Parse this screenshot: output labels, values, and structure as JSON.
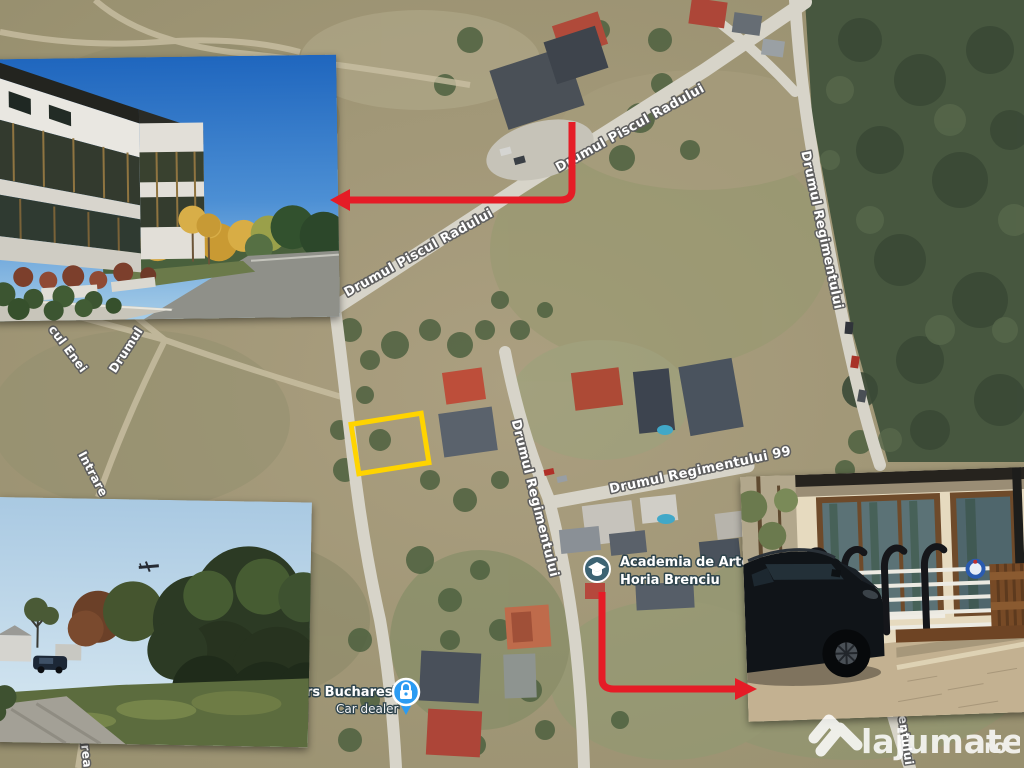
{
  "map": {
    "street_labels": [
      {
        "id": "piscul-radului-lower",
        "text": "Drumul Piscul Radului"
      },
      {
        "id": "piscul-radului-upper",
        "text": "Drumul Piscul Radului"
      },
      {
        "id": "regimentului-right",
        "text": "Drumul Regimentului"
      },
      {
        "id": "regimentului-middle",
        "text": "Drumul Regimentului"
      },
      {
        "id": "regimentului-99",
        "text": "Drumul Regimentului 99"
      },
      {
        "id": "regimentului-bottom-partial",
        "text": "mentului"
      },
      {
        "id": "cul-enei-partial",
        "text": "cul Enei"
      },
      {
        "id": "drumul-partial",
        "text": "Drumul"
      },
      {
        "id": "intrare-partial",
        "text": "Intrare"
      },
      {
        "id": "area-partial",
        "text": "area"
      }
    ],
    "pois": {
      "school": {
        "line1": "Academia de Arte",
        "line2": "Horia Brenciu",
        "icon": "graduation-cap",
        "color": "#3d6373"
      },
      "car_dealer": {
        "line1": "rs Bucharest",
        "line2": "Car dealer",
        "icon": "padlock",
        "color": "#2b9bf2"
      }
    },
    "colors": {
      "plot_highlight": "#ffd400",
      "annotation_arrow": "#e51c26",
      "label_outline": "#5e5e5e"
    }
  },
  "watermark": {
    "brand": "lajumate",
    "tld": ".ro"
  }
}
